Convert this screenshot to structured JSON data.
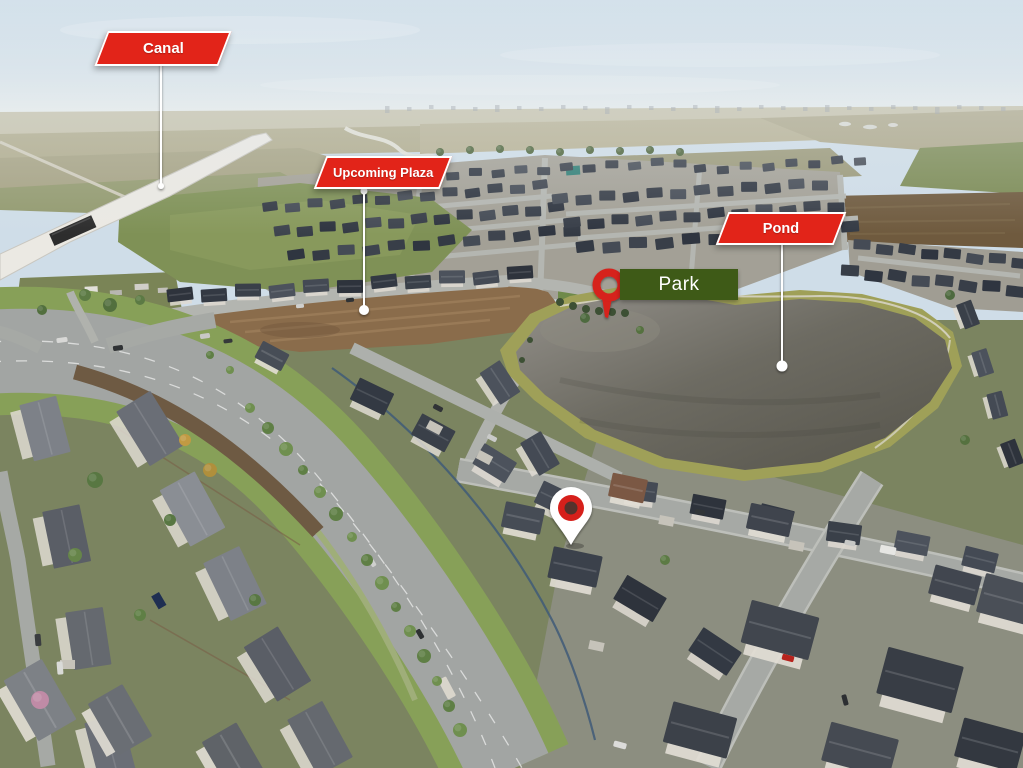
{
  "annotations": {
    "canal": {
      "label": "Canal"
    },
    "plaza": {
      "label": "Upcoming Plaza"
    },
    "pond": {
      "label": "Pond"
    },
    "park": {
      "label": "Park"
    }
  },
  "icons": {
    "park_pin": "ring-pin-icon",
    "house_pin": "location-pin-icon"
  },
  "colors": {
    "callout_background": "#e22419",
    "callout_border": "#ffffff",
    "callout_text": "#ffffff",
    "park_background": "#3e5a17",
    "park_text": "#ffffff",
    "leader_line": "#ffffff",
    "pin_red": "#d6201b",
    "pin_inner": "#55322c",
    "pin_white": "#ffffff"
  }
}
